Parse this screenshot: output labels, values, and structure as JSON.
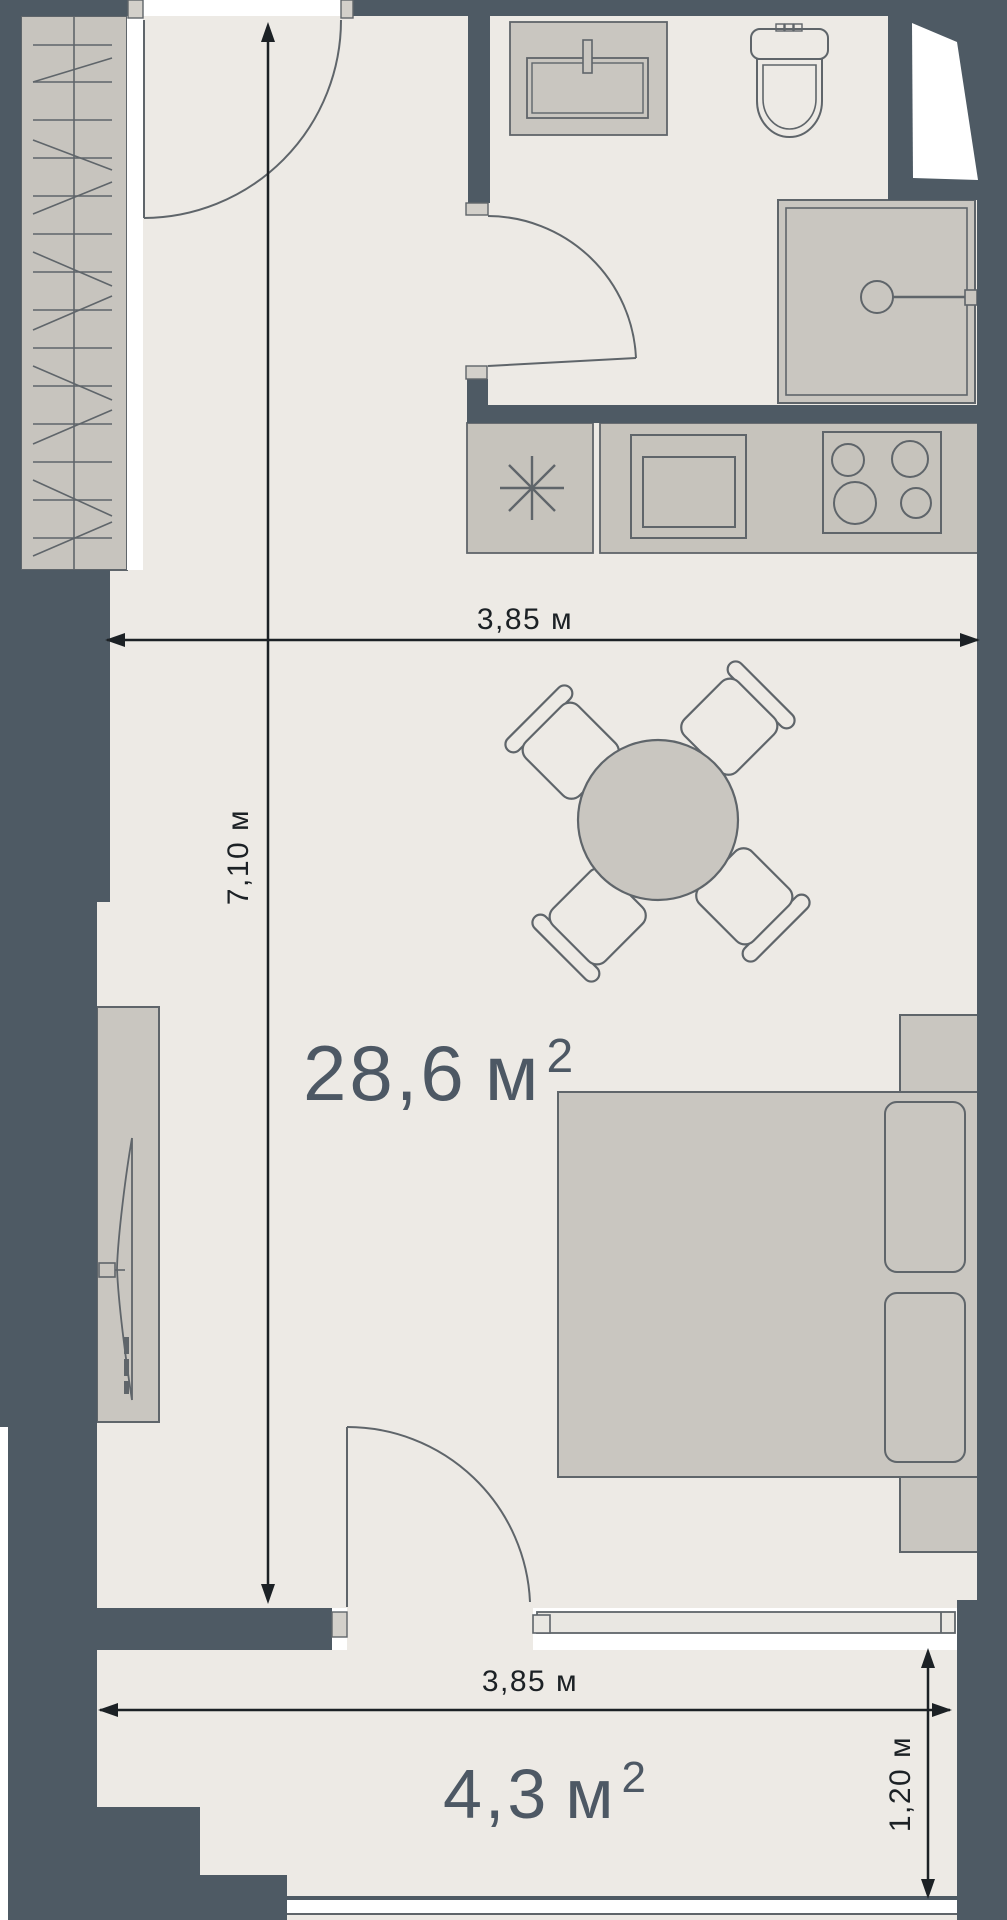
{
  "plan": {
    "title": "studio-apartment-floor-plan",
    "colors": {
      "wall": "#4e5a64",
      "floor": "#edeae5",
      "furniture_fill": "#c9c6c0",
      "counter_fill": "#c6c3bc",
      "wardrobe_fill": "#c7c4be",
      "outline": "#5f656a",
      "dimension_color": "#1c2125",
      "area_label_color": "#4d5864",
      "window_fill": "#e9e7e2",
      "jamb_fill": "#d3d0ca",
      "white": "#ffffff"
    },
    "main_room": {
      "area_value": "28,6",
      "area_unit": "м",
      "area_sup": "2",
      "width_label": "3,85 м",
      "height_label": "7,10 м"
    },
    "balcony": {
      "area_value": "4,3",
      "area_unit": "м",
      "area_sup": "2",
      "width_label": "3,85 м",
      "depth_label": "1,20 м"
    },
    "symbols": {
      "wardrobe": "hanger-rail-pattern",
      "entrance_door": "quarter-arc-door",
      "bathroom_door": "quarter-arc-door",
      "balcony_door": "quarter-arc-door",
      "sink": "rect-basin-with-tap",
      "toilet": "tank-and-bowl",
      "shower": "square-tray-with-drain",
      "washer_place": "asterisk",
      "oven": "nested-rects",
      "cooktop": "four-burners",
      "dining_table": "round-table",
      "chair": "seat-with-back",
      "bed": "mattress-with-pillows",
      "nightstand": "small-square",
      "tv": "slim-panel-on-console",
      "window": "double-line-band"
    }
  }
}
